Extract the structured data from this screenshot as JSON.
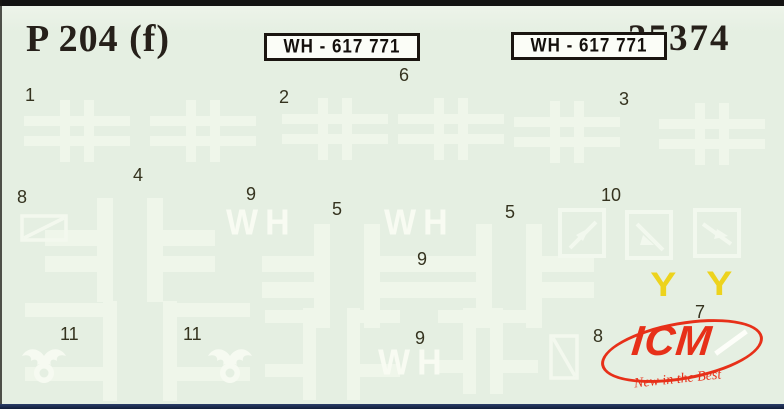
{
  "colors": {
    "background": "#e5efe2",
    "decal_white": "#eff6ea",
    "label_ink": "#35331f",
    "title_ink": "#26201a",
    "brand_red": "#e73019",
    "decal_yellow": "#edd31d",
    "plate_background": "#fbfdf7",
    "plate_border": "#1a1510",
    "bottom_strip_blue": "#15254a",
    "scan_edge_black": "#131312"
  },
  "header": {
    "title": "P 204 (f)",
    "kit_number": "35374"
  },
  "plate": {
    "text": "WH - 617 771"
  },
  "decal_numbers": [
    "1",
    "2",
    "3",
    "4",
    "5",
    "5",
    "6",
    "7",
    "8",
    "8",
    "9",
    "9",
    "9",
    "10",
    "11",
    "11"
  ],
  "wh_marking": "WH",
  "aerial_marking": "Y",
  "brand": {
    "name": "ICM",
    "slogan": "New in the Best"
  }
}
